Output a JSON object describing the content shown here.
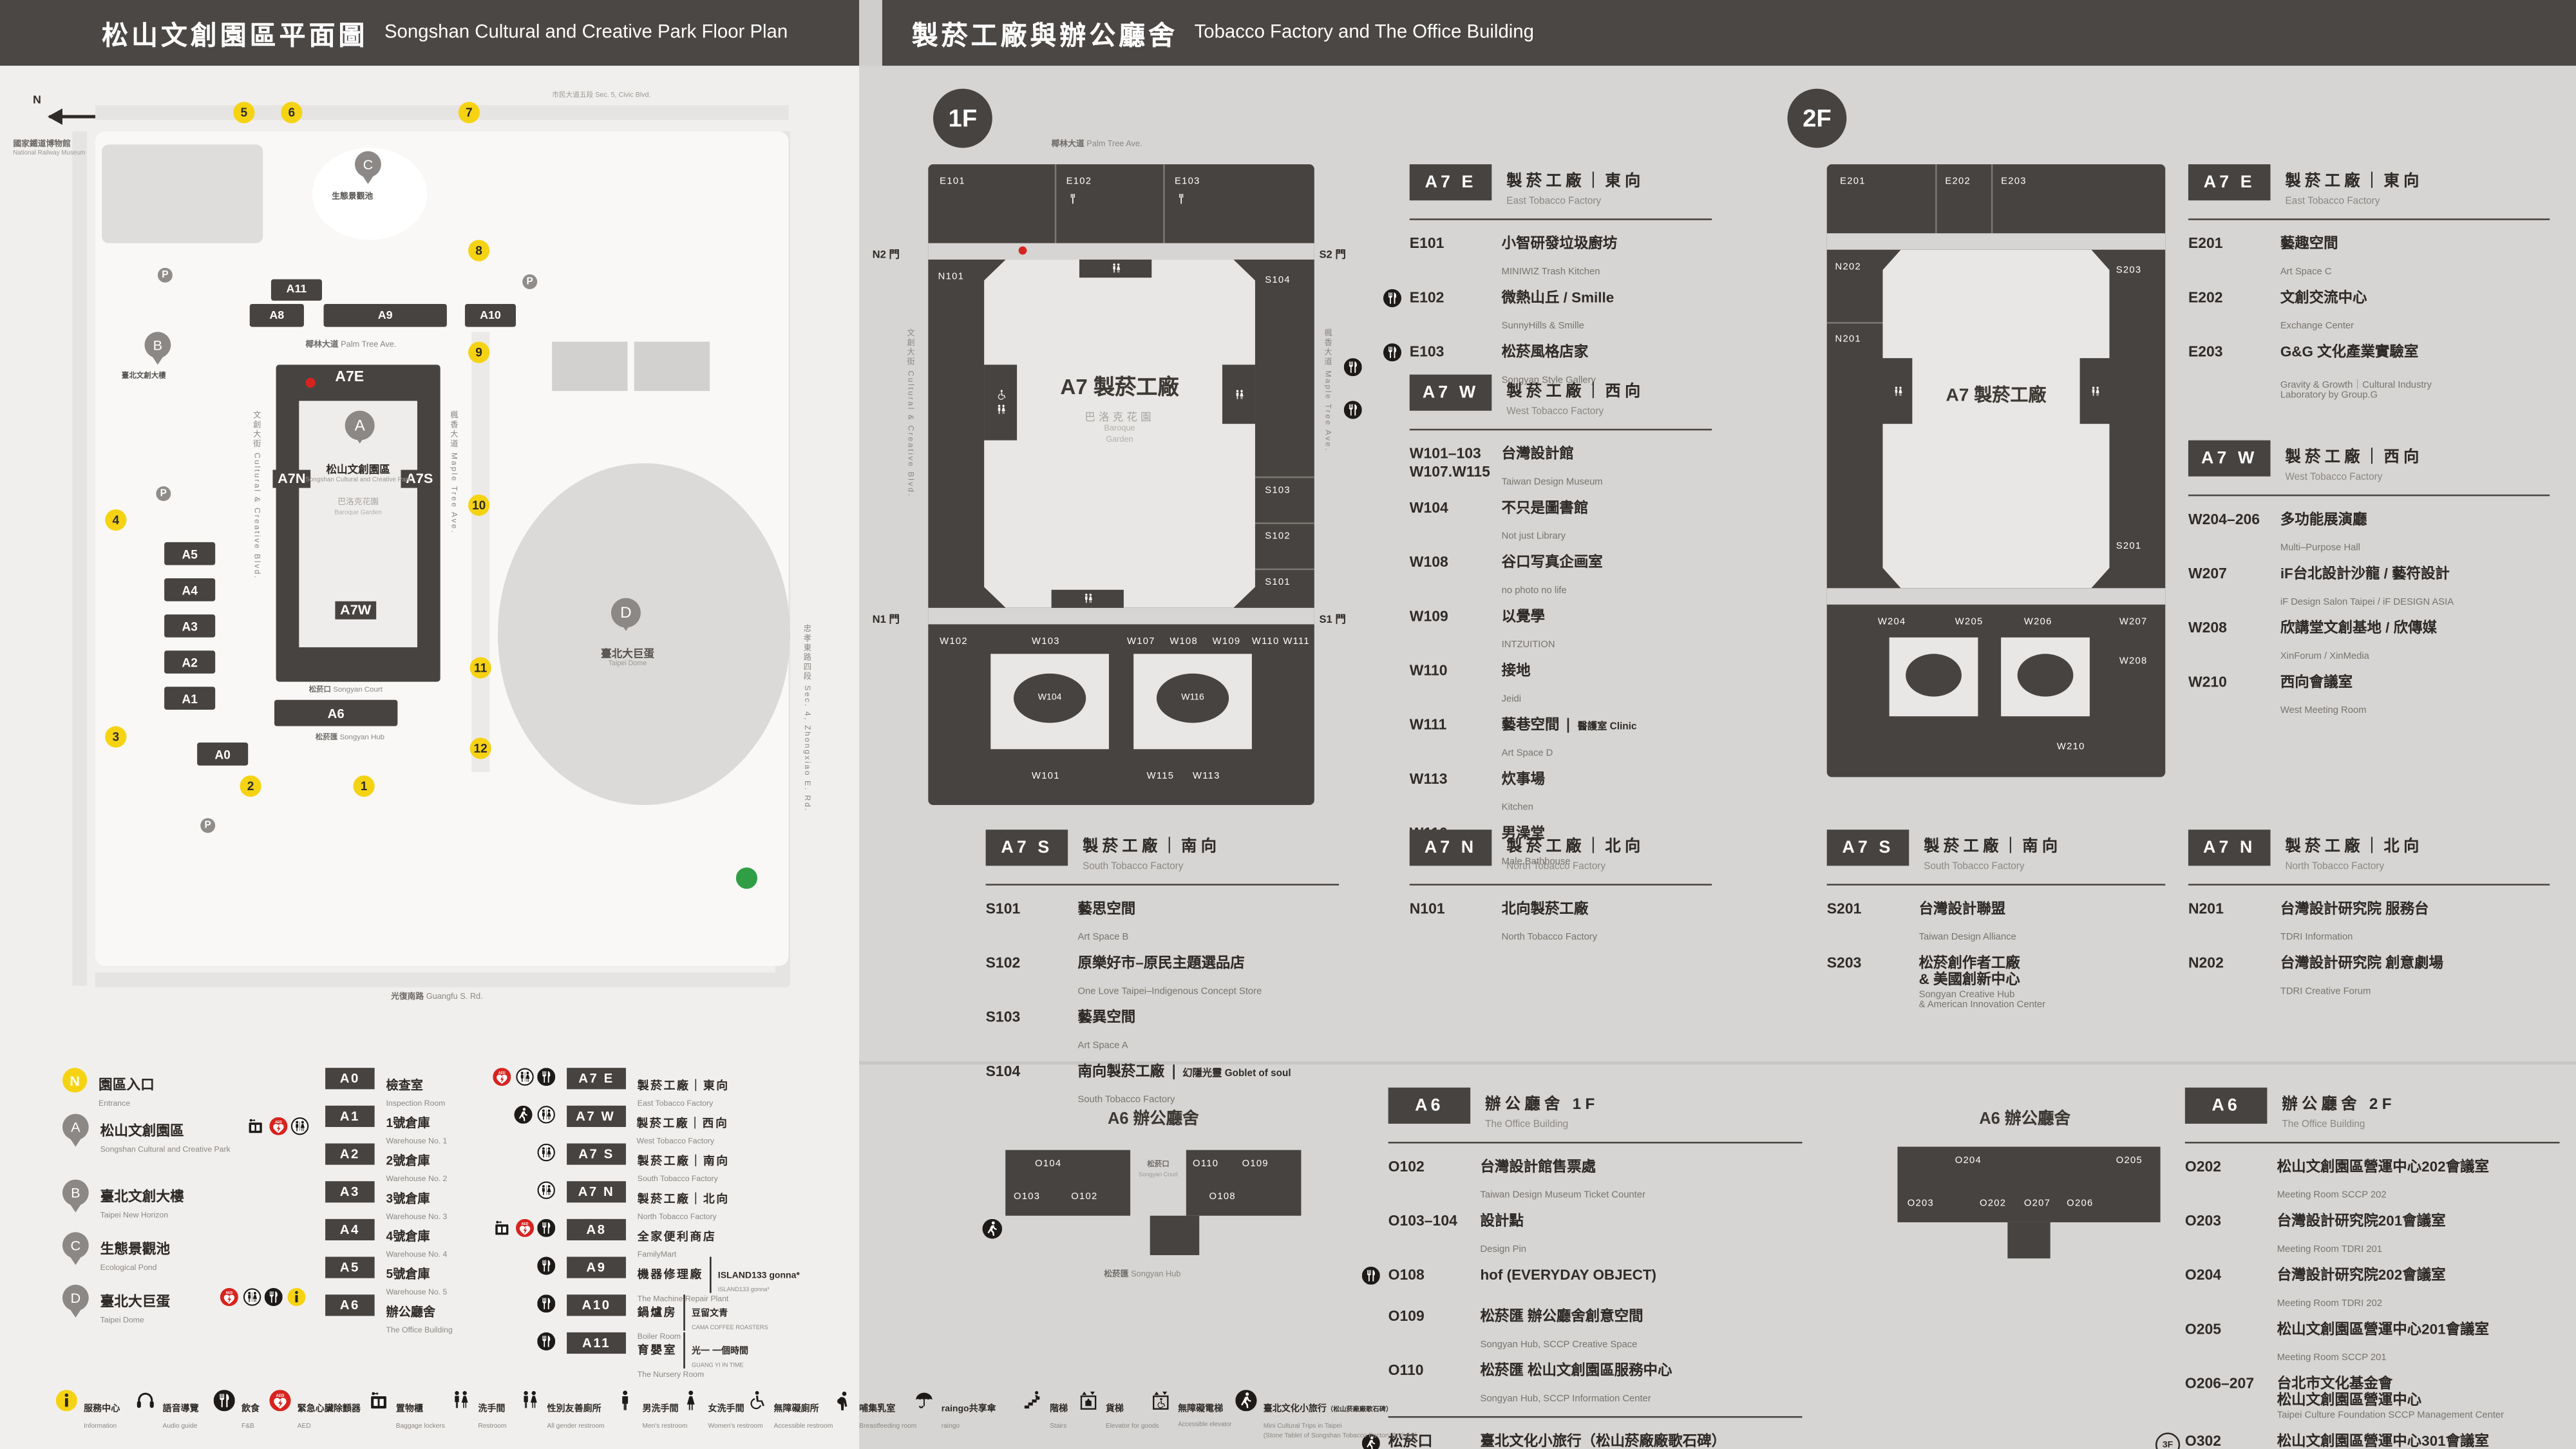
{
  "header": {
    "left_zh": "松山文創園區平面圖",
    "left_en": "Songshan Cultural and Creative Park Floor Plan",
    "right_zh": "製菸工廠與辦公廳舍",
    "right_en": "Tobacco Factory and The Office Building"
  },
  "badges": {
    "f1": "1F",
    "f2": "2F",
    "f3": "3F"
  },
  "m": {
    "compass": "N",
    "museum_zh": "國家鐵道博物館",
    "museum_en": "National Railway Museum",
    "civic_zh": "市民大道五段",
    "civic_en": "Sec. 5, Civic Blvd.",
    "palm_zh": "椰林大道",
    "palm_en": "Palm Tree Ave.",
    "cultural": "文創大街 Cultural & Creative Blvd.",
    "maple": "楓香大道 Maple Tree Ave.",
    "guangfu_zh": "光復南路",
    "guangfu_en": "Guangfu S. Rd.",
    "zhongxiao": "忠孝東路四段 Sec. 4, Zhongxiao E. Rd.",
    "park_zh": "松山文創園區",
    "park_en": "Songshan Cultural and Creative Park",
    "garden_zh": "巴洛克花園",
    "garden_en": "Baroque Garden",
    "pond_zh": "生態景觀池",
    "newhorizon_zh": "臺北文創大樓",
    "dome_zh": "臺北大巨蛋",
    "dome_en": "Taipei Dome",
    "court_zh": "松菸口",
    "court_en": "Songyan Court",
    "hub_zh": "松菸匯",
    "hub_en": "Songyan Hub",
    "p": "P",
    "pins": {
      "a": "A",
      "b": "B",
      "c": "C",
      "d": "D"
    },
    "blocks": {
      "a0": "A0",
      "a1": "A1",
      "a2": "A2",
      "a3": "A3",
      "a4": "A4",
      "a5": "A5",
      "a6": "A6",
      "a7e": "A7E",
      "a7n": "A7N",
      "a7s": "A7S",
      "a7w": "A7W",
      "a8": "A8",
      "a9": "A9",
      "a10": "A10",
      "a11": "A11"
    },
    "numbers": [
      "1",
      "2",
      "3",
      "4",
      "5",
      "6",
      "7",
      "8",
      "9",
      "10",
      "11",
      "12"
    ]
  },
  "d1": {
    "top": [
      "E101",
      "E102",
      "E103"
    ],
    "left": "N101",
    "right": [
      "S104",
      "S103",
      "S102",
      "S101"
    ],
    "b1": [
      "W102",
      "W103",
      "W107",
      "W108",
      "W109",
      "W110",
      "W111"
    ],
    "ov": [
      "W104",
      "W116"
    ],
    "b2": [
      "W101",
      "W115",
      "W113"
    ],
    "center": "A7 製菸工廠",
    "garden_zh": "巴洛克花園",
    "garden_en1": "Baroque",
    "garden_en2": "Garden",
    "n2": "N2 門",
    "s2": "S2 門",
    "n1": "N1 門",
    "s1": "S1 門",
    "street_top_zh": "椰林大道",
    "street_top_en": "Palm Tree Ave.",
    "street_left": "文創大街 Cultural & Creative Blvd.",
    "street_right": "楓香大道 Maple Tree Ave."
  },
  "d2": {
    "top": [
      "E201",
      "E202",
      "E203"
    ],
    "left": [
      "N202",
      "N201"
    ],
    "right": [
      "S203",
      "S201"
    ],
    "b1": [
      "W204",
      "W205",
      "W206"
    ],
    "r2": [
      "W207",
      "W208"
    ],
    "w210": "W210",
    "center": "A7 製菸工廠"
  },
  "s1e": {
    "code": "A7 E",
    "zh": "製菸工廠｜東向",
    "en": "East Tobacco Factory",
    "rooms": [
      {
        "no": "E101",
        "zh": "小智研發垃圾廚坊",
        "en": "MINIWIZ Trash Kitchen"
      },
      {
        "no": "E102",
        "zh": "微熱山丘 / Smille",
        "en": "SunnyHills & Smille"
      },
      {
        "no": "E103",
        "zh": "松菸風格店家",
        "en": "Songyan Style Gallery"
      }
    ]
  },
  "s1w": {
    "code": "A7 W",
    "zh": "製菸工廠｜西向",
    "en": "West Tobacco Factory",
    "rooms": [
      {
        "no": "W101–103",
        "no2": "W107.W115",
        "zh": "台灣設計館",
        "en": "Taiwan Design Museum"
      },
      {
        "no": "W104",
        "zh": "不只是圖書館",
        "en": "Not just Library"
      },
      {
        "no": "W108",
        "zh": "谷口写真企画室",
        "en": "no photo no life"
      },
      {
        "no": "W109",
        "zh": "以覺學",
        "en": "INTZUITION"
      },
      {
        "no": "W110",
        "zh": "接地",
        "en": "Jeidi"
      },
      {
        "no": "W111",
        "zh": "藝巷空間",
        "en": "Art Space D",
        "note": "醫護室 Clinic"
      },
      {
        "no": "W113",
        "zh": "炊事場",
        "en": "Kitchen"
      },
      {
        "no": "W116",
        "zh": "男澡堂",
        "en": "Male Bathhouse"
      }
    ]
  },
  "s1s": {
    "code": "A7 S",
    "zh": "製菸工廠｜南向",
    "en": "South Tobacco Factory",
    "rooms": [
      {
        "no": "S101",
        "zh": "藝思空間",
        "en": "Art Space B"
      },
      {
        "no": "S102",
        "zh": "原樂好市–原民主題選品店",
        "en": "One Love Taipei–Indigenous Concept Store"
      },
      {
        "no": "S103",
        "zh": "藝異空間",
        "en": "Art Space A"
      },
      {
        "no": "S104",
        "zh": "南向製菸工廠",
        "en": "South Tobacco Factory",
        "note": "幻隱光靈 Goblet of soul"
      }
    ]
  },
  "s1n": {
    "code": "A7 N",
    "zh": "製菸工廠｜北向",
    "en": "North Tobacco Factory",
    "rooms": [
      {
        "no": "N101",
        "zh": "北向製菸工廠",
        "en": "North Tobacco Factory"
      }
    ]
  },
  "s2e": {
    "code": "A7 E",
    "zh": "製菸工廠｜東向",
    "en": "East Tobacco Factory",
    "rooms": [
      {
        "no": "E201",
        "zh": "藝趣空間",
        "en": "Art Space C"
      },
      {
        "no": "E202",
        "zh": "文創交流中心",
        "en": "Exchange Center"
      },
      {
        "no": "E203",
        "zh": "G&G 文化產業實驗室",
        "en": "Gravity & Growth｜Cultural Industry\nLaboratory by Group.G"
      }
    ]
  },
  "s2w": {
    "code": "A7 W",
    "zh": "製菸工廠｜西向",
    "en": "West Tobacco Factory",
    "rooms": [
      {
        "no": "W204–206",
        "zh": "多功能展演廳",
        "en": "Multi–Purpose Hall"
      },
      {
        "no": "W207",
        "zh": "iF台北設計沙龍 / 藝符設計",
        "en": "iF Design Salon Taipei / iF DESIGN ASIA"
      },
      {
        "no": "W208",
        "zh": "欣講堂文創基地 / 欣傳媒",
        "en": "XinForum / XinMedia"
      },
      {
        "no": "W210",
        "zh": "西向會議室",
        "en": "West Meeting Room"
      }
    ]
  },
  "s2s": {
    "code": "A7 S",
    "zh": "製菸工廠｜南向",
    "en": "South Tobacco Factory",
    "rooms": [
      {
        "no": "S201",
        "zh": "台灣設計聯盟",
        "en": "Taiwan Design Alliance"
      },
      {
        "no": "S203",
        "zh": "松菸創作者工廠\n& 美國創新中心",
        "en": "Songyan Creative Hub\n& American Innovation Center"
      }
    ]
  },
  "s2n": {
    "code": "A7 N",
    "zh": "製菸工廠｜北向",
    "en": "North Tobacco Factory",
    "rooms": [
      {
        "no": "N201",
        "zh": "台灣設計研究院 服務台",
        "en": "TDRI Information"
      },
      {
        "no": "N202",
        "zh": "台灣設計研究院 創意劇場",
        "en": "TDRI Creative Forum"
      }
    ]
  },
  "o1": {
    "code": "A6",
    "zh": "辦公廳舍 1F",
    "en": "The Office Building",
    "rooms": [
      {
        "no": "O102",
        "zh": "台灣設計館售票處",
        "en": "Taiwan Design Museum Ticket Counter"
      },
      {
        "no": "O103–104",
        "zh": "設計點",
        "en": "Design Pin"
      },
      {
        "no": "O108",
        "zh": "hof (EVERYDAY OBJECT)",
        "en": ""
      },
      {
        "no": "O109",
        "zh": "松菸匯 辦公廳舍創意空間",
        "en": "Songyan Hub, SCCP Creative Space"
      },
      {
        "no": "O110",
        "zh": "松菸匯 松山文創園區服務中心",
        "en": "Songyan Hub, SCCP Information Center"
      }
    ],
    "court": {
      "no_zh": "松菸口",
      "no_en": "Songyan Court",
      "zh": "臺北文化小旅行（松山菸廠廠歌石碑）",
      "en": "Mini Cultural Trips in Taipei (Stone Tablet of Songshan Tobacco Factory Anthem)"
    }
  },
  "o2": {
    "code": "A6",
    "zh": "辦公廳舍 2F",
    "en": "The Office Building",
    "rooms": [
      {
        "no": "O202",
        "zh": "松山文創園區營運中心202會議室",
        "en": "Meeting Room SCCP 202"
      },
      {
        "no": "O203",
        "zh": "台灣設計研究院201會議室",
        "en": "Meeting Room TDRI 201"
      },
      {
        "no": "O204",
        "zh": "台灣設計研究院202會議室",
        "en": "Meeting Room TDRI 202"
      },
      {
        "no": "O205",
        "zh": "松山文創園區營運中心201會議室",
        "en": "Meeting Room SCCP 201"
      },
      {
        "no": "O206–207",
        "zh": "台北市文化基金會\n松山文創園區營運中心",
        "en": "Taipei Culture Foundation SCCP Management Center"
      },
      {
        "no": "O302",
        "zh": "松山文創園區營運中心301會議室",
        "en": "Meeting Room SCCP 301"
      }
    ]
  },
  "o1d": {
    "title": "A6 辦公廳舍",
    "court_zh": "松菸口",
    "court_en": "Songyan Court",
    "hub_zh": "松菸匯",
    "hub_en": "Songyan Hub",
    "rooms": [
      "O104",
      "O103",
      "O102",
      "O110",
      "O109",
      "O108"
    ]
  },
  "o2d": {
    "title": "A6 辦公廳舍",
    "rooms": [
      "O204",
      "O205",
      "O203",
      "O202",
      "O207",
      "O206"
    ]
  },
  "leg": {
    "places": [
      {
        "mk": "N",
        "zh": "園區入口",
        "en": "Entrance"
      },
      {
        "mk": "A",
        "zh": "松山文創園區",
        "en": "Songshan Cultural and Creative Park"
      },
      {
        "mk": "B",
        "zh": "臺北文創大樓",
        "en": "Taipei New Horizon"
      },
      {
        "mk": "C",
        "zh": "生態景觀池",
        "en": "Ecological Pond"
      },
      {
        "mk": "D",
        "zh": "臺北大巨蛋",
        "en": "Taipei Dome"
      }
    ],
    "colA": [
      {
        "code": "A0",
        "zh": "檢查室",
        "en": "Inspection Room"
      },
      {
        "code": "A1",
        "zh": "1號倉庫",
        "en": "Warehouse No. 1"
      },
      {
        "code": "A2",
        "zh": "2號倉庫",
        "en": "Warehouse No. 2"
      },
      {
        "code": "A3",
        "zh": "3號倉庫",
        "en": "Warehouse No. 3"
      },
      {
        "code": "A4",
        "zh": "4號倉庫",
        "en": "Warehouse No. 4"
      },
      {
        "code": "A5",
        "zh": "5號倉庫",
        "en": "Warehouse No. 5"
      },
      {
        "code": "A6",
        "zh": "辦公廳舍",
        "en": "The Office Building"
      }
    ],
    "colB": [
      {
        "code": "A7 E",
        "zh": "製菸工廠｜東向",
        "en": "East Tobacco Factory"
      },
      {
        "code": "A7 W",
        "zh": "製菸工廠｜西向",
        "en": "West Tobacco Factory"
      },
      {
        "code": "A7 S",
        "zh": "製菸工廠｜南向",
        "en": "South Tobacco Factory"
      },
      {
        "code": "A7 N",
        "zh": "製菸工廠｜北向",
        "en": "North Tobacco Factory"
      },
      {
        "code": "A8",
        "zh": "全家便利商店",
        "en": "FamilyMart"
      },
      {
        "code": "A9",
        "zh": "機器修理廠",
        "en": "The Machine Repair Plant",
        "n1": "ISLAND133 gonna*",
        "n2": "ISLAND133 gonna*"
      },
      {
        "code": "A10",
        "zh": "鍋爐房",
        "en": "Boiler Room",
        "n1": "豆留文青",
        "n2": "CAMA COFFEE ROASTERS"
      },
      {
        "code": "A11",
        "zh": "育嬰室",
        "en": "The Nursery Room",
        "n1": "光一 一個時間",
        "n2": "GUANG YI IN TIME"
      }
    ]
  },
  "fac": [
    {
      "zh": "服務中心",
      "en": "Information"
    },
    {
      "zh": "語音導覽",
      "en": "Audio guide"
    },
    {
      "zh": "飲食",
      "en": "F&B"
    },
    {
      "zh": "緊急心臟除顫器",
      "en": "AED"
    },
    {
      "zh": "置物櫃",
      "en": "Baggage lockers"
    },
    {
      "zh": "洗手間",
      "en": "Restroom"
    },
    {
      "zh": "性別友善廁所",
      "en": "All gender restroom"
    },
    {
      "zh": "男洗手間",
      "en": "Men's restroom"
    },
    {
      "zh": "女洗手間",
      "en": "Women's restroom"
    },
    {
      "zh": "無障礙廁所",
      "en": "Accessible restroom"
    },
    {
      "zh": "哺集乳室",
      "en": "Breastfeeding room"
    },
    {
      "zh": "raingo共享傘",
      "en": "raingo"
    },
    {
      "zh": "階梯",
      "en": "Stairs"
    },
    {
      "zh": "貨梯",
      "en": "Elevator for goods"
    },
    {
      "zh": "無障礙電梯",
      "en": "Accessible elevator"
    },
    {
      "zh": "臺北文化小旅行",
      "zh2": "（松山菸廠廠歌石碑）",
      "en": "Mini Cultural Trips in Taipei",
      "en2": "(Stone Tablet of Songshan Tobacco Factory Anthem)"
    }
  ]
}
